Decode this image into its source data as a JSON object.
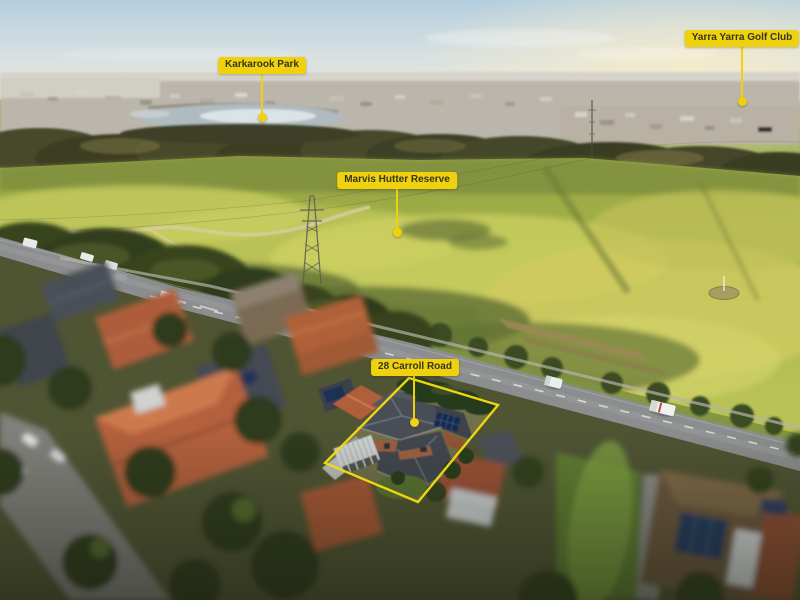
{
  "labels": {
    "karkarook": {
      "text": "Karkarook Park"
    },
    "yarra": {
      "text": "Yarra Yarra Golf Club"
    },
    "marvis": {
      "text": "Marvis Hutter Reserve"
    },
    "property": {
      "text": "28 Carroll Road"
    }
  },
  "colors": {
    "label_background": "#F0D10E",
    "label_text": "#333521",
    "property_outline": "#F2DA12"
  }
}
